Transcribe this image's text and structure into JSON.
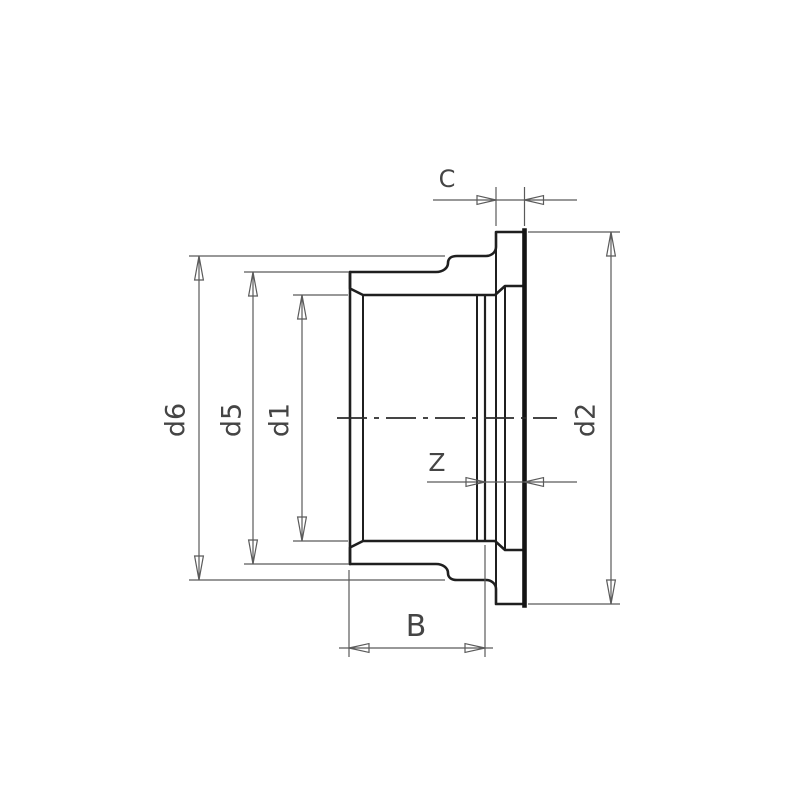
{
  "drawing": {
    "background_color": "#ffffff",
    "outline_color": "#1f1f1f",
    "hatch_color": "#6f6f6f",
    "dimension_line_color": "#5a5a5a",
    "text_color": "#454545",
    "labels": {
      "c": "C",
      "d6": "d6",
      "d5": "d5",
      "d1": "d1",
      "d2": "d2",
      "z": "Z",
      "b": "B"
    }
  }
}
